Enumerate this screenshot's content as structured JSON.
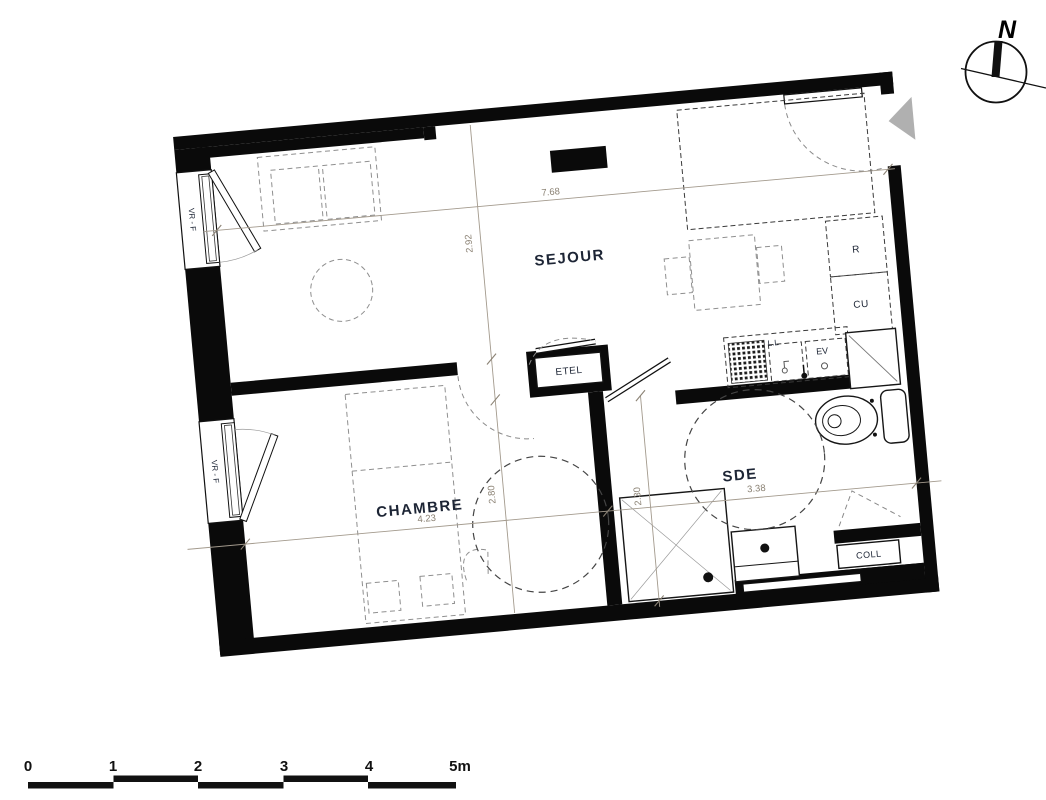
{
  "labels": {
    "rooms": {
      "sejour": "SEJOUR",
      "chambre": "CHAMBRE",
      "sde": "SDE"
    },
    "fixtures": {
      "etel": "ETEL",
      "coll": "COLL",
      "fridge": "R",
      "kitchen_unit": "CU",
      "sink": "EV",
      "washer": "L.L",
      "window_shutter": "VR - F"
    }
  },
  "dimensions": {
    "sejour_width": "7.68",
    "sejour_depth": "2.92",
    "chambre_width": "4.23",
    "chambre_depth": "2.80",
    "sde_width": "3.38",
    "sde_depth": "2.30"
  },
  "compass": {
    "north": "N"
  },
  "scale_bar": {
    "ticks": [
      "0",
      "1",
      "2",
      "3",
      "4"
    ],
    "end_label": "5m"
  },
  "colors": {
    "wall": "#0a0a0a",
    "label": "#1d2535",
    "dimension": "#8b8274",
    "furniture_dash": "#8f8f8f",
    "entry_arrow": "#b0b0b0"
  }
}
